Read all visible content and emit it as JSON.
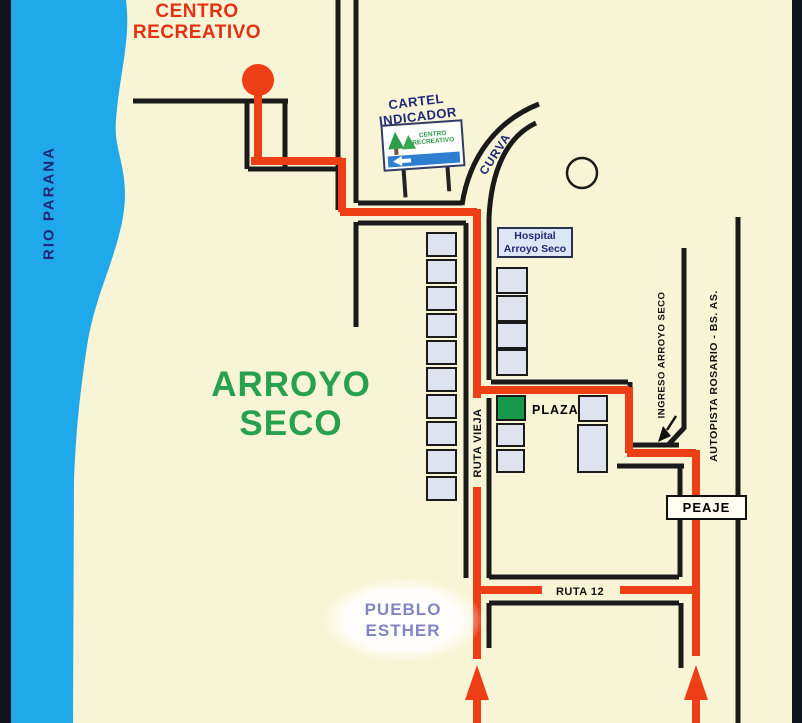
{
  "map": {
    "region_label": {
      "line1": "ARROYO",
      "line2": "SECO"
    },
    "river_label": "RIO PARANA",
    "destination": {
      "label_line1": "CENTRO",
      "label_line2": "RECREATIVO",
      "marker": "red-dot"
    },
    "billboard": {
      "caption_line1": "CARTEL",
      "caption_line2": "INDICADOR",
      "sign_text_line1": "CENTRO",
      "sign_text_line2": "RECREATIVO"
    },
    "roads": {
      "curva": "CURVA",
      "ruta_vieja": "RUTA VIEJA",
      "ingreso": "INGRESO ARROYO SECO",
      "autopista": "AUTOPISTA ROSARIO - BS. AS.",
      "ruta_12": "RUTA 12"
    },
    "places": {
      "hospital_line1": "Hospital",
      "hospital_line2": "Arroyo Seco",
      "plaza": "PLAZA",
      "peaje": "PEAJE",
      "pueblo_line1": "PUEBLO",
      "pueblo_line2": "ESTHER"
    },
    "icons": {
      "destination_marker": "red-dot-icon",
      "roundabout": "circle-icon",
      "route_direction_arrows": "up-arrow-icon",
      "ingreso_pointer": "down-left-arrow-icon"
    },
    "colors": {
      "background": "#f8f5d6",
      "river": "#1fa9ea",
      "route_red": "#ee3e16",
      "road_black": "#1a1a1a",
      "building_fill": "#dee3ef",
      "plaza_green": "#16994a",
      "navy_text": "#1f2878",
      "green_text": "#28a14e",
      "red_text": "#e53012",
      "purple_text": "#8285c4"
    }
  }
}
